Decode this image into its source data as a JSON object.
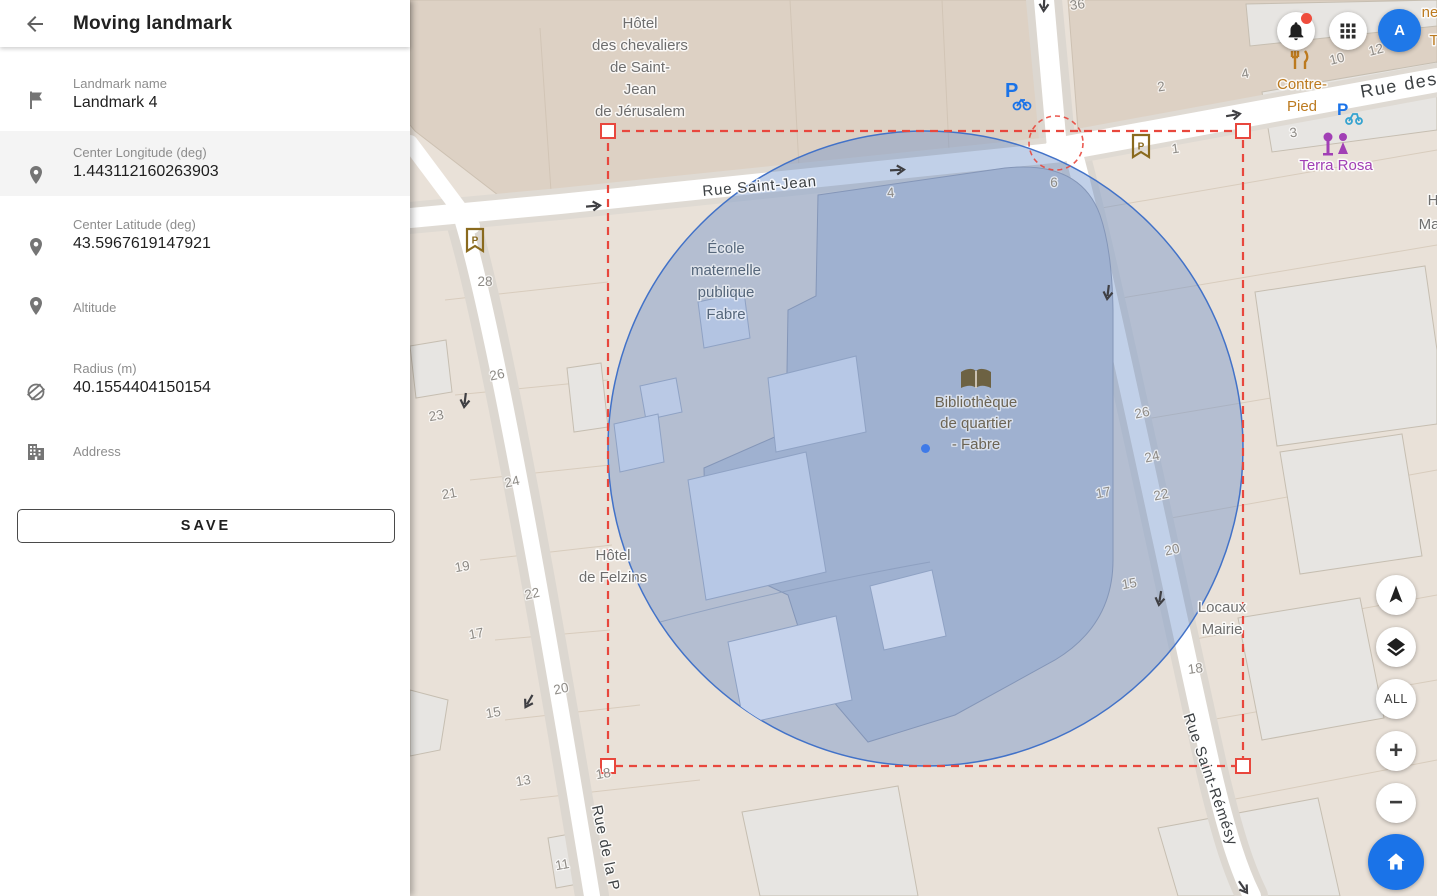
{
  "theme": {
    "accent_blue": "#1a73e8",
    "avatar_blue": "#1f78e8",
    "selection_red": "#e8473d",
    "circle_stroke": "#4272c8",
    "circle_fill": "#6c8fc7",
    "map_bg": "#e9e1d8"
  },
  "sidebar": {
    "title": "Moving landmark",
    "back_icon": "back-arrow-icon",
    "fields": [
      {
        "icon": "flag-icon",
        "label": "Landmark name",
        "value": "Landmark 4"
      },
      {
        "icon": "place-icon",
        "label": "Center Longitude (deg)",
        "value": "1.443112160263903",
        "highlighted": true
      },
      {
        "icon": "place-icon",
        "label": "Center Latitude (deg)",
        "value": "43.5967619147921"
      },
      {
        "icon": "place-icon",
        "label": "Altitude",
        "value": ""
      },
      {
        "icon": "radius-icon",
        "label": "Radius (m)",
        "value": "40.1554404150154"
      },
      {
        "icon": "building-icon",
        "label": "Address",
        "value": ""
      }
    ],
    "save_label": "SAVE"
  },
  "topbar": {
    "icons": [
      "bell-icon",
      "apps-grid-icon"
    ],
    "notification_dot": true,
    "avatar_letter": "A"
  },
  "map_controls": {
    "buttons": [
      "compass-button",
      "layers-button",
      "all-button",
      "zoom-in-button",
      "zoom-out-button",
      "home-button"
    ],
    "all_label": "ALL",
    "zoom_in_label": "+",
    "zoom_out_label": "−"
  },
  "map": {
    "poi_icons": [
      "library-icon",
      "restaurant-icon",
      "bar-icon",
      "parking-icon",
      "bike-parking-icon",
      "scooter-parking-icon",
      "one-way-arrow-icon"
    ],
    "labels": [
      {
        "text": "Hôtel",
        "x": 640,
        "y": 28,
        "cls": "poi"
      },
      {
        "text": "des chevaliers",
        "x": 640,
        "y": 50,
        "cls": "poi"
      },
      {
        "text": "de Saint-",
        "x": 640,
        "y": 72,
        "cls": "poi"
      },
      {
        "text": "Jean",
        "x": 640,
        "y": 94,
        "cls": "poi"
      },
      {
        "text": "de Jérusalem",
        "x": 640,
        "y": 116,
        "cls": "poi"
      },
      {
        "text": "Rue Saint-Jean",
        "x": 760,
        "y": 191,
        "cls": "st",
        "rot": -5
      },
      {
        "text": "Rue des",
        "x": 1400,
        "y": 91,
        "cls": "stbig",
        "rot": -10
      },
      {
        "text": "Rue Saint-Rémésy",
        "x": 1206,
        "y": 781,
        "cls": "st",
        "rot": 71
      },
      {
        "text": "Rue de la P",
        "x": 601,
        "y": 849,
        "cls": "st",
        "rot": 78
      },
      {
        "text": "École",
        "x": 726,
        "y": 253,
        "cls": "in"
      },
      {
        "text": "maternelle",
        "x": 726,
        "y": 275,
        "cls": "in"
      },
      {
        "text": "publique",
        "x": 726,
        "y": 297,
        "cls": "in"
      },
      {
        "text": "Fabre",
        "x": 726,
        "y": 319,
        "cls": "in"
      },
      {
        "text": "Bibliothèque",
        "x": 976,
        "y": 407,
        "cls": "lib"
      },
      {
        "text": "de quartier",
        "x": 976,
        "y": 428,
        "cls": "lib"
      },
      {
        "text": "- Fabre",
        "x": 976,
        "y": 449,
        "cls": "lib"
      },
      {
        "text": "Hôtel",
        "x": 613,
        "y": 560,
        "cls": "poi"
      },
      {
        "text": "de Felzins",
        "x": 613,
        "y": 582,
        "cls": "poi"
      },
      {
        "text": "Locaux",
        "x": 1222,
        "y": 612,
        "cls": "poi"
      },
      {
        "text": "Mairie",
        "x": 1222,
        "y": 634,
        "cls": "poi"
      },
      {
        "text": "Contre-",
        "x": 1302,
        "y": 89,
        "cls": "orange"
      },
      {
        "text": "Pied",
        "x": 1302,
        "y": 111,
        "cls": "orange"
      },
      {
        "text": "Terra Rosa",
        "x": 1336,
        "y": 170,
        "cls": "purple"
      },
      {
        "text": "ne",
        "x": 1430,
        "y": 17,
        "cls": "orange"
      },
      {
        "text": "T",
        "x": 1434,
        "y": 45,
        "cls": "orange"
      },
      {
        "text": "H",
        "x": 1433,
        "y": 205,
        "cls": "poi"
      },
      {
        "text": "Ma",
        "x": 1429,
        "y": 229,
        "cls": "poi"
      },
      {
        "text": "36",
        "x": 1078,
        "y": 9,
        "cls": "num",
        "rot": -8
      },
      {
        "text": "28",
        "x": 485,
        "y": 286,
        "cls": "num"
      },
      {
        "text": "26",
        "x": 498,
        "y": 379,
        "cls": "num",
        "rot": -12
      },
      {
        "text": "23",
        "x": 437,
        "y": 420,
        "cls": "num",
        "rot": -10
      },
      {
        "text": "24",
        "x": 513,
        "y": 486,
        "cls": "num",
        "rot": -12
      },
      {
        "text": "21",
        "x": 450,
        "y": 498,
        "cls": "num",
        "rot": -10
      },
      {
        "text": "19",
        "x": 463,
        "y": 571,
        "cls": "num",
        "rot": -10
      },
      {
        "text": "22",
        "x": 533,
        "y": 598,
        "cls": "num",
        "rot": -12
      },
      {
        "text": "17",
        "x": 477,
        "y": 638,
        "cls": "num",
        "rot": -10
      },
      {
        "text": "15",
        "x": 494,
        "y": 717,
        "cls": "num",
        "rot": -10
      },
      {
        "text": "13",
        "x": 524,
        "y": 785,
        "cls": "num",
        "rot": -10
      },
      {
        "text": "11",
        "x": 563,
        "y": 869,
        "cls": "num",
        "rot": -10
      },
      {
        "text": "20",
        "x": 562,
        "y": 693,
        "cls": "num",
        "rot": -12
      },
      {
        "text": "18",
        "x": 604,
        "y": 778,
        "cls": "num",
        "rot": -10
      },
      {
        "text": "26",
        "x": 1143,
        "y": 417,
        "cls": "num",
        "rot": -12
      },
      {
        "text": "24",
        "x": 1153,
        "y": 461,
        "cls": "num",
        "rot": -12
      },
      {
        "text": "22",
        "x": 1162,
        "y": 499,
        "cls": "num",
        "rot": -12
      },
      {
        "text": "17",
        "x": 1104,
        "y": 497,
        "cls": "num",
        "rot": -10
      },
      {
        "text": "20",
        "x": 1173,
        "y": 554,
        "cls": "num",
        "rot": -12
      },
      {
        "text": "15",
        "x": 1130,
        "y": 588,
        "cls": "num",
        "rot": -10
      },
      {
        "text": "18",
        "x": 1196,
        "y": 673,
        "cls": "num",
        "rot": -8
      },
      {
        "text": "2",
        "x": 1162,
        "y": 91,
        "cls": "num",
        "rot": -10
      },
      {
        "text": "4",
        "x": 1246,
        "y": 78,
        "cls": "num",
        "rot": -10
      },
      {
        "text": "10",
        "x": 1338,
        "y": 63,
        "cls": "num",
        "rot": -14
      },
      {
        "text": "12",
        "x": 1377,
        "y": 54,
        "cls": "num",
        "rot": -14
      },
      {
        "text": "3",
        "x": 1294,
        "y": 137,
        "cls": "num",
        "rot": -8
      },
      {
        "text": "1",
        "x": 1176,
        "y": 153,
        "cls": "num",
        "rot": -8
      },
      {
        "text": "6",
        "x": 1054,
        "y": 187,
        "cls": "num"
      },
      {
        "text": "4",
        "x": 891,
        "y": 197,
        "cls": "num",
        "rot": -4
      }
    ]
  }
}
